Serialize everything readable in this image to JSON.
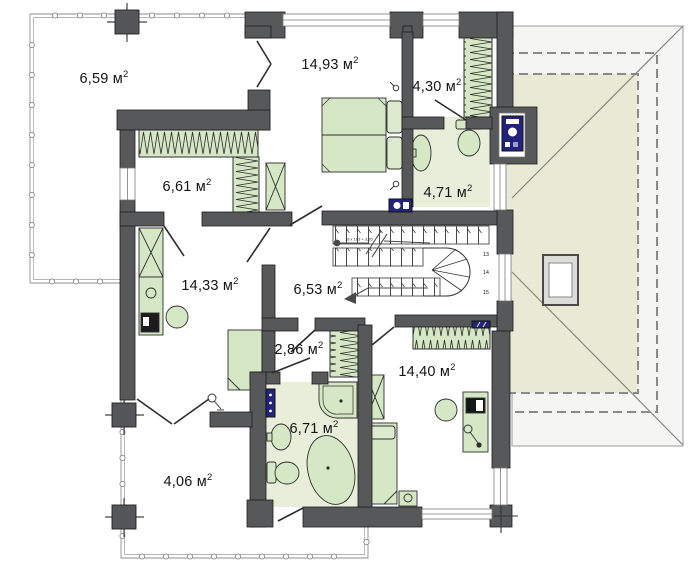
{
  "plan": {
    "area_superscript": "2",
    "rooms": [
      {
        "id": "terrace-upper",
        "label": "6,59 м"
      },
      {
        "id": "bedroom-master",
        "label": "14,93 м"
      },
      {
        "id": "wardrobe-top",
        "label": "4,30 м"
      },
      {
        "id": "walk-in-closet",
        "label": "6,61 м"
      },
      {
        "id": "bathroom-upper",
        "label": "4,71 м"
      },
      {
        "id": "room-left",
        "label": "14,33 м"
      },
      {
        "id": "hallway",
        "label": "6,53 м"
      },
      {
        "id": "closet-small",
        "label": "2,86 м"
      },
      {
        "id": "bedroom-lower",
        "label": "14,40 м"
      },
      {
        "id": "bathroom-lower",
        "label": "6,71 м"
      },
      {
        "id": "terrace-lower",
        "label": "4,06 м"
      }
    ],
    "stairs": {
      "annotation": "18 x 103 + 3,35",
      "step_numbers": [
        "13",
        "14",
        "15"
      ]
    },
    "colors": {
      "wall": "#57585a",
      "furniture_green": "#d5e7c5",
      "wet_floor": "#e9eedb",
      "roof_plane": "#e9ead6",
      "roof_eave": "#f5f5f3",
      "accent_blue": "#23237d"
    }
  }
}
